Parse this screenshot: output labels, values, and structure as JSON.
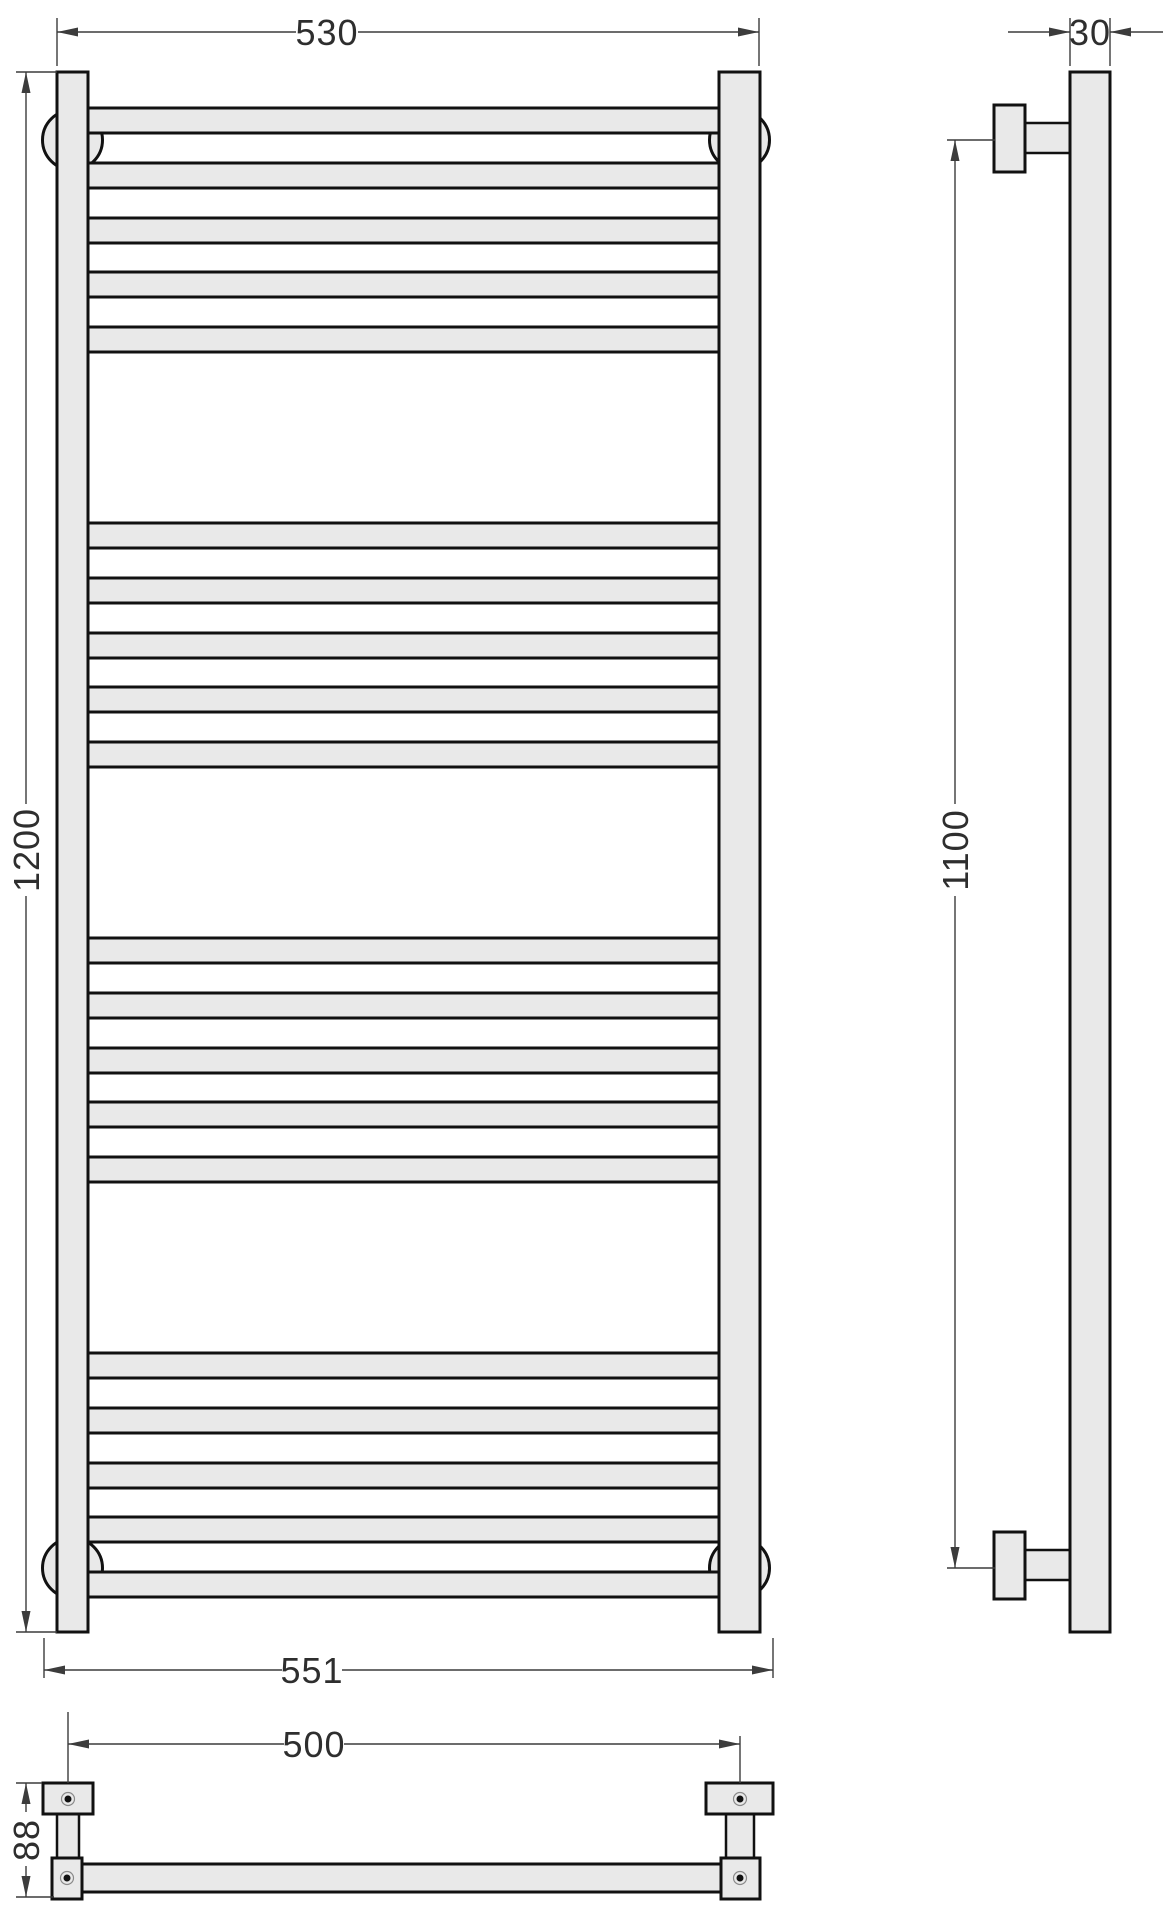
{
  "dims": {
    "front_width_top": "530",
    "side_depth": "30",
    "front_height": "1200",
    "side_bracket_span": "1100",
    "front_width_overall": "551",
    "bottom_bracket_span": "500",
    "bottom_bracket_height": "88"
  },
  "colors": {
    "outline": "#111111",
    "part_fill": "#e9e9e9",
    "dim_line": "#3c3c3c",
    "dim_text": "#2e2e2e",
    "background": "#ffffff"
  }
}
